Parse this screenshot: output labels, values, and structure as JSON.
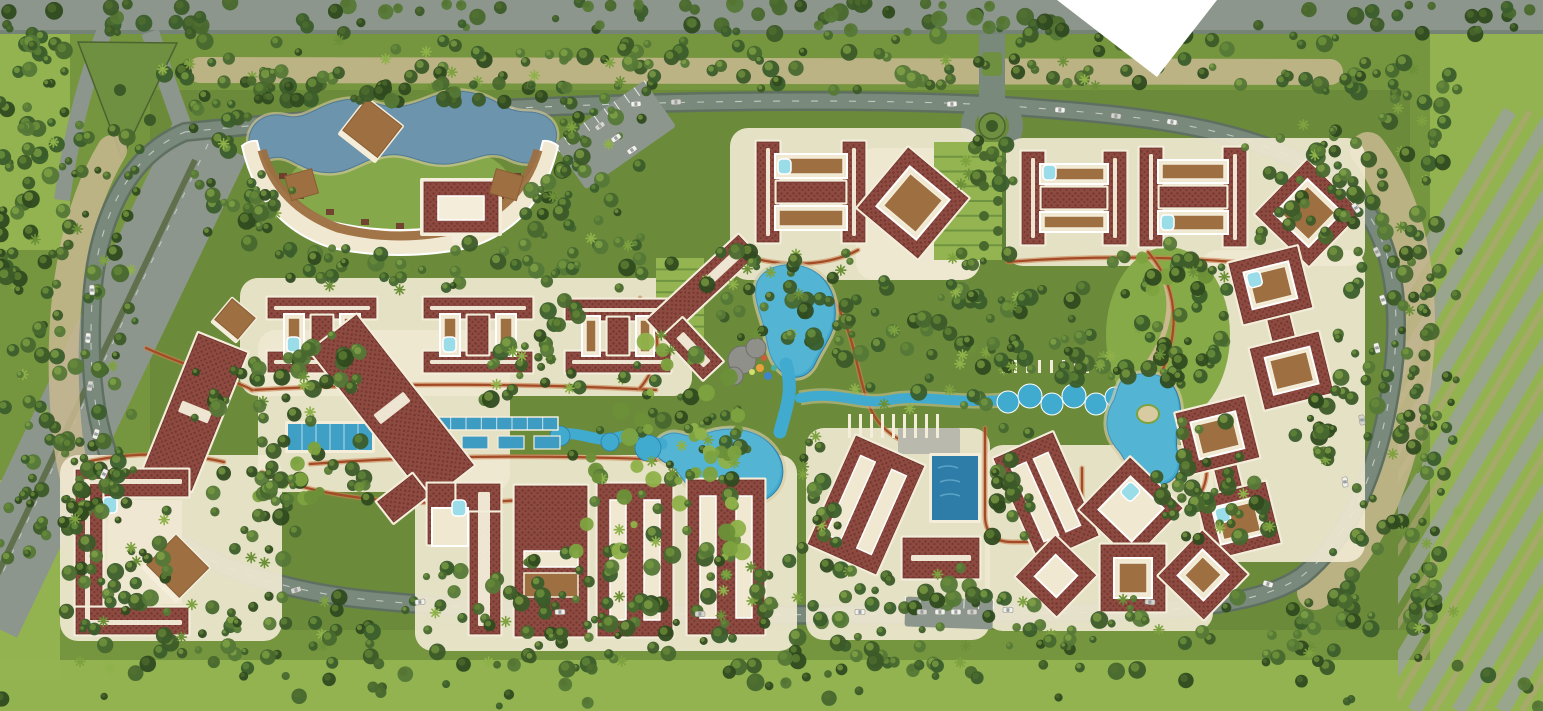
{
  "meta": {
    "title": "resort-master-plan-aerial-rendering",
    "canvas": {
      "w": 1543,
      "h": 711
    }
  },
  "palette": {
    "baseGreen": "#76953f",
    "innerGreen": "#6a8a3b",
    "brightGreen": "#93b450",
    "lawn": "#85a84b",
    "darkTree": [
      "#2f4a1f",
      "#3c5a28",
      "#48682e",
      "#557837",
      "#3a5d2b"
    ],
    "lightTree": [
      "#7da23f",
      "#8fb14a",
      "#6c9038"
    ],
    "roadGray": "#79897b",
    "roadDark": "#5f7061",
    "extGray": "#8d968c",
    "tan": "#c8b991",
    "scrub": "#b3a47c",
    "cream": "#f0e8d1",
    "roofDark": "#6e312b",
    "roofMid": "#8d4a40",
    "trim": "#f3edda",
    "deckBrown": "#9d6f41",
    "poolBlue": "#41aacf",
    "poolDeep": "#2e7ca8",
    "poolLite": "#9adde9",
    "lagoonBlue": "#6d94ad",
    "pathRed": "#a34a27",
    "pathFill": "#c8824f",
    "sand": "#d9cba1",
    "rock": "#90908a",
    "white": "#ffffff",
    "carBody": "#f2f2ec"
  },
  "scene": {
    "fields": [
      {
        "n": "field-right",
        "x": 1430,
        "y": 30,
        "w": 113,
        "h": 681,
        "f": "brightGreen"
      },
      {
        "n": "field-bottom",
        "x": 0,
        "y": 660,
        "w": 1543,
        "h": 51,
        "f": "brightGreen"
      },
      {
        "n": "field-left-top",
        "x": 0,
        "y": 30,
        "w": 70,
        "h": 220,
        "f": "brightGreen"
      },
      {
        "n": "field-left-bottom",
        "x": 0,
        "y": 480,
        "w": 60,
        "h": 200,
        "f": "brightGreen"
      },
      {
        "n": "inner-ground",
        "x": 150,
        "y": 90,
        "w": 1260,
        "h": 540,
        "f": "innerGreen"
      }
    ],
    "topBand": {
      "x": 0,
      "y": 0,
      "w": 1543,
      "h": 34
    },
    "notch": "1057,0 1217,0 1157,77",
    "ringRoad": "M185,132 C420,108 720,96 945,103 C1000,105 1010,106 1060,110 C1160,118 1270,132 1342,186 C1392,224 1402,298 1393,372 C1383,452 1357,532 1302,576 C1250,612 1140,614 960,613 C760,617 520,614 382,601 C272,592 175,558 128,498 C95,440 88,380 92,300 C96,230 122,158 185,132 Z",
    "tanBelts": [
      {
        "d": "M1368,150 C1416,215 1424,305 1412,390 C1398,470 1370,548 1315,592",
        "w": 36,
        "c": "tan"
      },
      {
        "d": "M112,150 C70,220 58,320 66,420 C72,500 100,560 150,596",
        "w": 30,
        "c": "tan"
      },
      {
        "d": "M200,70 L1330,72",
        "w": 26,
        "c": "tan"
      }
    ],
    "extHighway": {
      "d": "M-20,620 L210,140",
      "w": 82,
      "median": "M-15,600 L195,160"
    },
    "forkIsland": "78,42 177,43 122,158",
    "rightStrips": {
      "clip": {
        "x": 1398,
        "y": 38,
        "w": 145,
        "h": 673
      },
      "x0": 1150,
      "step": 44,
      "len": 360,
      "drop": 600,
      "w": 14
    },
    "entrance": {
      "d": "M992,34 L992,120",
      "w": 26,
      "island": {
        "x": 982,
        "y": 52,
        "w": 20,
        "h": 24
      }
    },
    "roundabout": {
      "cx": 992,
      "cy": 126,
      "rOuter": 24,
      "rGreen": 13
    },
    "greenAlley": {
      "x": 976,
      "y": 148,
      "w": 30,
      "h": 112
    },
    "plazas": [
      [
        240,
        278,
        452,
        118
      ],
      [
        730,
        128,
        250,
        152
      ],
      [
        1005,
        138,
        360,
        128
      ],
      [
        1200,
        250,
        165,
        312
      ],
      [
        60,
        455,
        222,
        186
      ],
      [
        258,
        330,
        252,
        162
      ],
      [
        415,
        455,
        382,
        196
      ],
      [
        806,
        428,
        184,
        212
      ],
      [
        985,
        445,
        228,
        186
      ],
      [
        856,
        148,
        124,
        132
      ]
    ],
    "terracottaPaths": [
      "M252,390 C390,382 540,384 656,390",
      "M310,464 C470,452 640,456 760,466",
      "M640,298 C664,330 662,362 640,388",
      "M834,300 C862,346 856,402 884,428 C900,444 920,448 940,448",
      "M985,428 L985,515 Q985,542 1012,542 L1058,542 Q1082,542 1082,518 L1082,468",
      "M1008,262 C1080,256 1160,256 1235,262",
      "M1148,252 C1186,296 1178,352 1148,396 C1136,414 1124,424 1112,432",
      "M736,252 C772,268 826,268 858,250",
      "M146,348 C190,368 240,382 252,390",
      "M262,472 C320,500 420,508 520,500",
      "M86,462 C130,452 180,452 224,462",
      "M1190,432 C1210,452 1212,480 1196,500"
    ],
    "gardens": {
      "lawnCrescent": {
        "cx": 400,
        "cy": 186,
        "rx": 112,
        "ry": 48
      },
      "terraces": [
        {
          "x": 656,
          "y": 258,
          "w": 48,
          "h": 80,
          "lines": 7
        },
        {
          "x": 934,
          "y": 142,
          "w": 68,
          "h": 118,
          "lines": 8
        }
      ],
      "rightGarden": {
        "cx": 1168,
        "cy": 335,
        "rx": 62,
        "ry": 88,
        "path": "M1150,258 C1180,290 1170,330 1150,360 C1138,380 1128,398 1124,416"
      }
    },
    "water": {
      "lagoon": "M250,150 C244,128 262,110 286,116 C306,121 318,104 344,100 C368,96 380,110 404,106 C428,102 440,88 468,92 C498,97 502,112 528,112 C550,112 562,128 554,146 C548,162 528,168 508,158 C488,148 474,162 448,164 C420,166 408,150 382,156 C356,162 348,176 320,172 C296,168 290,154 272,158 C258,161 252,158 250,150 Z",
      "topPool": "M772,268 C800,258 828,272 834,300 C840,330 824,344 816,362 C808,380 790,382 778,368 C766,354 768,338 762,320 C754,296 750,278 772,268 Z",
      "riverNeck": "M786,364 C794,392 786,408 780,432",
      "centerPool": "M700,436 C726,424 756,428 772,446 C788,464 786,486 768,498 C748,512 716,512 700,498 C684,486 680,470 668,464 C650,456 652,440 668,434 C680,430 690,440 700,436 Z",
      "westChain": "M556,436 C576,428 596,444 616,438 C632,432 644,442 662,444",
      "eastChannel": "M800,398 C840,390 860,406 890,400 C920,394 950,404 1005,400",
      "scallops": [
        [
          1008,
          402,
          11
        ],
        [
          1030,
          396,
          12
        ],
        [
          1052,
          404,
          11
        ],
        [
          1074,
          396,
          12
        ],
        [
          1096,
          404,
          11
        ],
        [
          1115,
          397,
          10
        ]
      ],
      "westBlobs": [
        [
          560,
          436,
          10
        ],
        [
          610,
          442,
          9
        ],
        [
          648,
          448,
          13
        ],
        [
          700,
          507,
          11
        ]
      ],
      "rightPool": "M1125,378 C1150,368 1172,376 1178,396 C1186,420 1172,434 1178,454 C1184,474 1170,488 1152,484 C1130,480 1128,462 1118,450 C1104,434 1104,416 1114,400 C1118,390 1118,382 1125,378 Z",
      "island": {
        "cx": 1148,
        "cy": 414,
        "rx": 11,
        "ry": 9
      },
      "lapPool": {
        "x": 288,
        "y": 424,
        "w": 84,
        "h": 26,
        "lanes": 6
      },
      "reflectChannel": {
        "x": 420,
        "y": 417,
        "w": 138,
        "h": 13,
        "ticks": 9
      },
      "basins": [
        [
          426,
          436
        ],
        [
          462,
          436
        ],
        [
          498,
          436
        ],
        [
          534,
          436
        ]
      ],
      "rectPool": {
        "x": 932,
        "y": 456,
        "w": 46,
        "h": 64
      },
      "terrace": {
        "x": 898,
        "y": 428,
        "w": 62,
        "h": 26
      }
    },
    "rocks": [
      [
        742,
        360,
        14
      ],
      [
        756,
        348,
        10
      ],
      [
        734,
        376,
        9
      ]
    ],
    "playDots": [
      [
        760,
        368,
        4,
        "#e8a23c"
      ],
      [
        768,
        376,
        4,
        "#3e86c8"
      ],
      [
        752,
        372,
        3,
        "#d0e06a"
      ],
      [
        764,
        358,
        3,
        "#cf5b3a"
      ],
      [
        774,
        368,
        3,
        "#49b0a0"
      ]
    ],
    "slatRows": [
      {
        "x": 848,
        "y": 414,
        "n": 9,
        "dx": 11,
        "w": 3,
        "h": 24
      },
      {
        "x": 1002,
        "y": 360,
        "n": 9,
        "dx": 12,
        "w": 3,
        "h": 13
      }
    ],
    "parking": [
      {
        "cx": 615,
        "cy": 135,
        "w": 110,
        "h": 56,
        "rot": -35,
        "stalls": 9
      },
      {
        "cx": 949,
        "cy": 613,
        "w": 88,
        "h": 30,
        "rot": 2,
        "stalls": 6
      }
    ],
    "buildings": [
      {
        "id": "clubhouse-crescent",
        "t": "crescent"
      },
      {
        "id": "bldg-h-1",
        "t": "hh",
        "x": 268,
        "y": 298,
        "w": 108,
        "h": 74,
        "pool": true
      },
      {
        "id": "bldg-h-2",
        "t": "hh",
        "x": 424,
        "y": 298,
        "w": 108,
        "h": 74,
        "pool": true
      },
      {
        "id": "bldg-h-3",
        "t": "hh",
        "x": 566,
        "y": 300,
        "w": 104,
        "h": 72,
        "pool": false
      },
      {
        "id": "bldg-l-1",
        "t": "lrot",
        "cx": 702,
        "cy": 287,
        "rot": 47
      },
      {
        "id": "bldg-h-top",
        "t": "hv",
        "x": 757,
        "y": 142,
        "w": 108,
        "h": 100,
        "pool": true
      },
      {
        "id": "bldg-ring-top",
        "t": "ring",
        "cx": 913,
        "cy": 203,
        "w": 78,
        "h": 78,
        "rot": 40,
        "deck": true
      },
      {
        "id": "bldg-h-tr1",
        "t": "hv",
        "x": 1022,
        "y": 152,
        "w": 104,
        "h": 92,
        "pool": true
      },
      {
        "id": "bldg-h-tr2",
        "t": "hv",
        "x": 1140,
        "y": 148,
        "w": 106,
        "h": 98,
        "pool": false
      },
      {
        "id": "bldg-ring-tr",
        "t": "ring",
        "cx": 1308,
        "cy": 213,
        "w": 74,
        "h": 74,
        "rot": 44,
        "deck": true
      },
      {
        "id": "bldg-dumbbell-1",
        "t": "dumbbell",
        "cx": 1281,
        "cy": 328,
        "len": 150,
        "rot": -14,
        "poolEnd": "top"
      },
      {
        "id": "bldg-dumbbell-2",
        "t": "dumbbell",
        "cx": 1228,
        "cy": 478,
        "len": 150,
        "rot": -14,
        "poolEnd": "bottom"
      },
      {
        "id": "bldg-bar-left-1",
        "t": "barridge",
        "cx": 195,
        "cy": 412,
        "w": 52,
        "h": 148,
        "rot": 22
      },
      {
        "id": "bldg-bar-left-2",
        "t": "barridge",
        "cx": 392,
        "cy": 408,
        "w": 58,
        "h": 190,
        "rot": -38,
        "wing": true
      },
      {
        "id": "bldg-u-bl",
        "t": "ubldg",
        "x": 76,
        "y": 470,
        "w": 112,
        "h": 164
      },
      {
        "id": "bldg-u-bm",
        "t": "hookbldg",
        "x": 428,
        "y": 484
      },
      {
        "id": "bldg-slot-1",
        "t": "slotted",
        "cx": 551,
        "cy": 561,
        "w": 72,
        "h": 150,
        "rot": 0,
        "hslot": true
      },
      {
        "id": "bldg-slot-2",
        "t": "slotted",
        "cx": 635,
        "cy": 560,
        "w": 74,
        "h": 152,
        "rot": 0
      },
      {
        "id": "bldg-slot-3",
        "t": "slotted",
        "cx": 726,
        "cy": 557,
        "w": 76,
        "h": 154,
        "rot": 0
      },
      {
        "id": "bldg-slot-4",
        "t": "slotted",
        "cx": 866,
        "cy": 505,
        "w": 74,
        "h": 118,
        "rot": 24
      },
      {
        "id": "bldg-slot-5",
        "t": "slotted",
        "cx": 1046,
        "cy": 497,
        "w": 64,
        "h": 112,
        "rot": -24
      },
      {
        "id": "pavilion",
        "t": "pav",
        "x": 903,
        "y": 538,
        "w": 76,
        "h": 40
      },
      {
        "id": "bldg-ring-br1",
        "t": "ring",
        "cx": 1131,
        "cy": 509,
        "w": 72,
        "h": 72,
        "rot": 44,
        "pool": true
      },
      {
        "id": "bldg-ring-br2",
        "t": "ring",
        "cx": 1133,
        "cy": 578,
        "w": 64,
        "h": 66,
        "rot": 0,
        "deck": true
      },
      {
        "id": "bldg-ring-br3",
        "t": "ring",
        "cx": 1203,
        "cy": 575,
        "w": 62,
        "h": 62,
        "rot": 44,
        "deck": true
      },
      {
        "id": "bldg-ring-br4",
        "t": "ring",
        "cx": 1056,
        "cy": 576,
        "w": 56,
        "h": 56,
        "rot": 44,
        "deck": false
      }
    ],
    "decks": [
      {
        "cx": 371,
        "cy": 130,
        "s": 44,
        "rot": 38
      },
      {
        "cx": 234,
        "cy": 320,
        "s": 30,
        "rot": 40
      },
      {
        "cx": 176,
        "cy": 568,
        "s": 46,
        "rot": 45
      },
      {
        "cx": 302,
        "cy": 186,
        "s": 28,
        "rot": -16,
        "flat": true
      },
      {
        "cx": 506,
        "cy": 186,
        "s": 28,
        "rot": 16,
        "flat": true
      }
    ],
    "smallPools": [
      [
        103,
        497
      ],
      [
        452,
        500
      ]
    ],
    "treeBelts": [
      [
        0,
        2,
        1543,
        32,
        110,
        0
      ],
      [
        130,
        34,
        1230,
        58,
        140,
        1
      ],
      [
        0,
        36,
        70,
        240,
        55,
        1
      ],
      [
        0,
        260,
        60,
        300,
        45,
        1
      ],
      [
        60,
        120,
        80,
        380,
        55,
        1
      ],
      [
        60,
        500,
        110,
        120,
        38,
        1
      ],
      [
        1330,
        50,
        110,
        580,
        110,
        1
      ],
      [
        1400,
        60,
        60,
        600,
        60,
        1
      ],
      [
        70,
        595,
        1290,
        75,
        180,
        1
      ],
      [
        0,
        662,
        1543,
        45,
        50,
        0
      ],
      [
        190,
        92,
        70,
        140,
        26,
        1
      ],
      [
        560,
        95,
        90,
        160,
        36,
        1
      ],
      [
        236,
        240,
        440,
        50,
        50,
        1
      ],
      [
        186,
        356,
        130,
        70,
        26,
        1
      ],
      [
        250,
        440,
        120,
        60,
        26,
        2
      ],
      [
        540,
        300,
        40,
        90,
        16,
        1
      ],
      [
        700,
        250,
        110,
        90,
        28,
        1
      ],
      [
        620,
        330,
        120,
        110,
        36,
        2
      ],
      [
        560,
        430,
        190,
        130,
        55,
        2
      ],
      [
        790,
        240,
        60,
        120,
        22,
        1
      ],
      [
        850,
        280,
        140,
        130,
        36,
        1
      ],
      [
        930,
        250,
        90,
        120,
        26,
        1
      ],
      [
        1240,
        120,
        120,
        120,
        32,
        1
      ],
      [
        1000,
        280,
        230,
        90,
        40,
        1
      ],
      [
        1090,
        240,
        140,
        60,
        22,
        2
      ],
      [
        1180,
        420,
        60,
        120,
        22,
        1
      ],
      [
        990,
        420,
        40,
        120,
        18,
        1
      ],
      [
        800,
        430,
        40,
        120,
        18,
        1
      ],
      [
        410,
        560,
        400,
        70,
        50,
        1
      ],
      [
        820,
        560,
        170,
        60,
        26,
        1
      ],
      [
        1150,
        470,
        120,
        60,
        22,
        1
      ],
      [
        60,
        440,
        60,
        80,
        18,
        1
      ],
      [
        210,
        470,
        90,
        100,
        26,
        1
      ],
      [
        300,
        330,
        60,
        60,
        16,
        1
      ],
      [
        480,
        330,
        70,
        70,
        18,
        1
      ],
      [
        680,
        420,
        60,
        60,
        16,
        2
      ],
      [
        240,
        170,
        60,
        60,
        14,
        1
      ],
      [
        520,
        170,
        60,
        70,
        16,
        1
      ],
      [
        960,
        130,
        60,
        60,
        14,
        1
      ],
      [
        1290,
        380,
        60,
        80,
        18,
        1
      ],
      [
        240,
        80,
        330,
        22,
        36,
        0
      ],
      [
        1060,
        350,
        160,
        36,
        26,
        1
      ]
    ],
    "cars": [
      [
        636,
        104,
        -3
      ],
      [
        676,
        102,
        -2
      ],
      [
        952,
        104,
        -2
      ],
      [
        1060,
        110,
        4
      ],
      [
        1116,
        116,
        7
      ],
      [
        1172,
        122,
        9
      ],
      [
        1356,
        208,
        55
      ],
      [
        1377,
        252,
        65
      ],
      [
        1383,
        300,
        72
      ],
      [
        1377,
        348,
        76
      ],
      [
        1362,
        420,
        80
      ],
      [
        1345,
        482,
        82
      ],
      [
        1268,
        584,
        18
      ],
      [
        1150,
        602,
        5
      ],
      [
        1008,
        610,
        2
      ],
      [
        860,
        612,
        1
      ],
      [
        700,
        614,
        0
      ],
      [
        560,
        612,
        -1
      ],
      [
        420,
        602,
        -6
      ],
      [
        296,
        590,
        -16
      ],
      [
        104,
        474,
        -65
      ],
      [
        96,
        434,
        -72
      ],
      [
        90,
        386,
        -80
      ],
      [
        88,
        338,
        -85
      ],
      [
        92,
        290,
        -92
      ],
      [
        600,
        126,
        -35
      ],
      [
        616,
        138,
        -35
      ],
      [
        632,
        150,
        -35
      ],
      [
        922,
        612,
        0
      ],
      [
        940,
        612,
        0
      ],
      [
        956,
        612,
        0
      ],
      [
        972,
        612,
        0
      ]
    ]
  }
}
